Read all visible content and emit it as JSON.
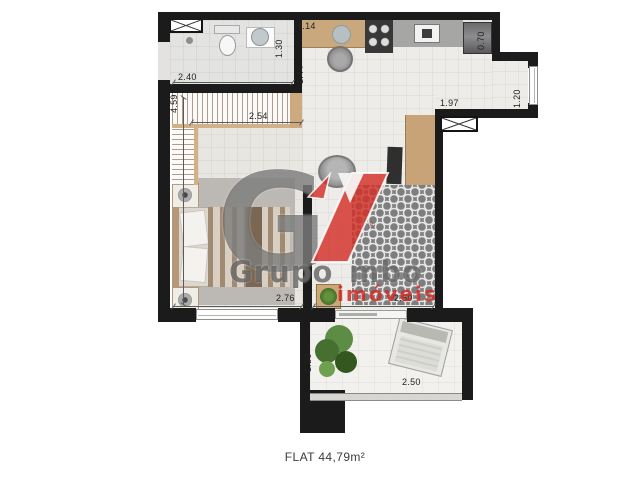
{
  "floorplan": {
    "caption": "FLAT 44,79m²",
    "dimensions": {
      "kitchen_top": "4.14",
      "bathroom_depth": "1.30",
      "bathroom_width": "2.40",
      "kitchen_left_depth": "1.44",
      "left_wall_length": "4.59",
      "closet_run": "2.54",
      "fridge_width": "0.70",
      "entry_recess_width": "0.69",
      "entry_window_height": "1.20",
      "entry_wall_width": "1.97",
      "bedroom_width": "2.76",
      "living_width": "2.50",
      "balcony_depth": "1.50",
      "balcony_width": "2.50"
    },
    "watermark": {
      "monogram": "G",
      "brand_word1": "Grupo",
      "brand_word2": "mbo",
      "brand_sub": "imóveis",
      "registered_mark": "®"
    },
    "colors": {
      "wall": "#1b1b1b",
      "brand_red": "#d32f28",
      "brand_gray": "#4f4f4f",
      "wood": "#c9a87c"
    }
  }
}
